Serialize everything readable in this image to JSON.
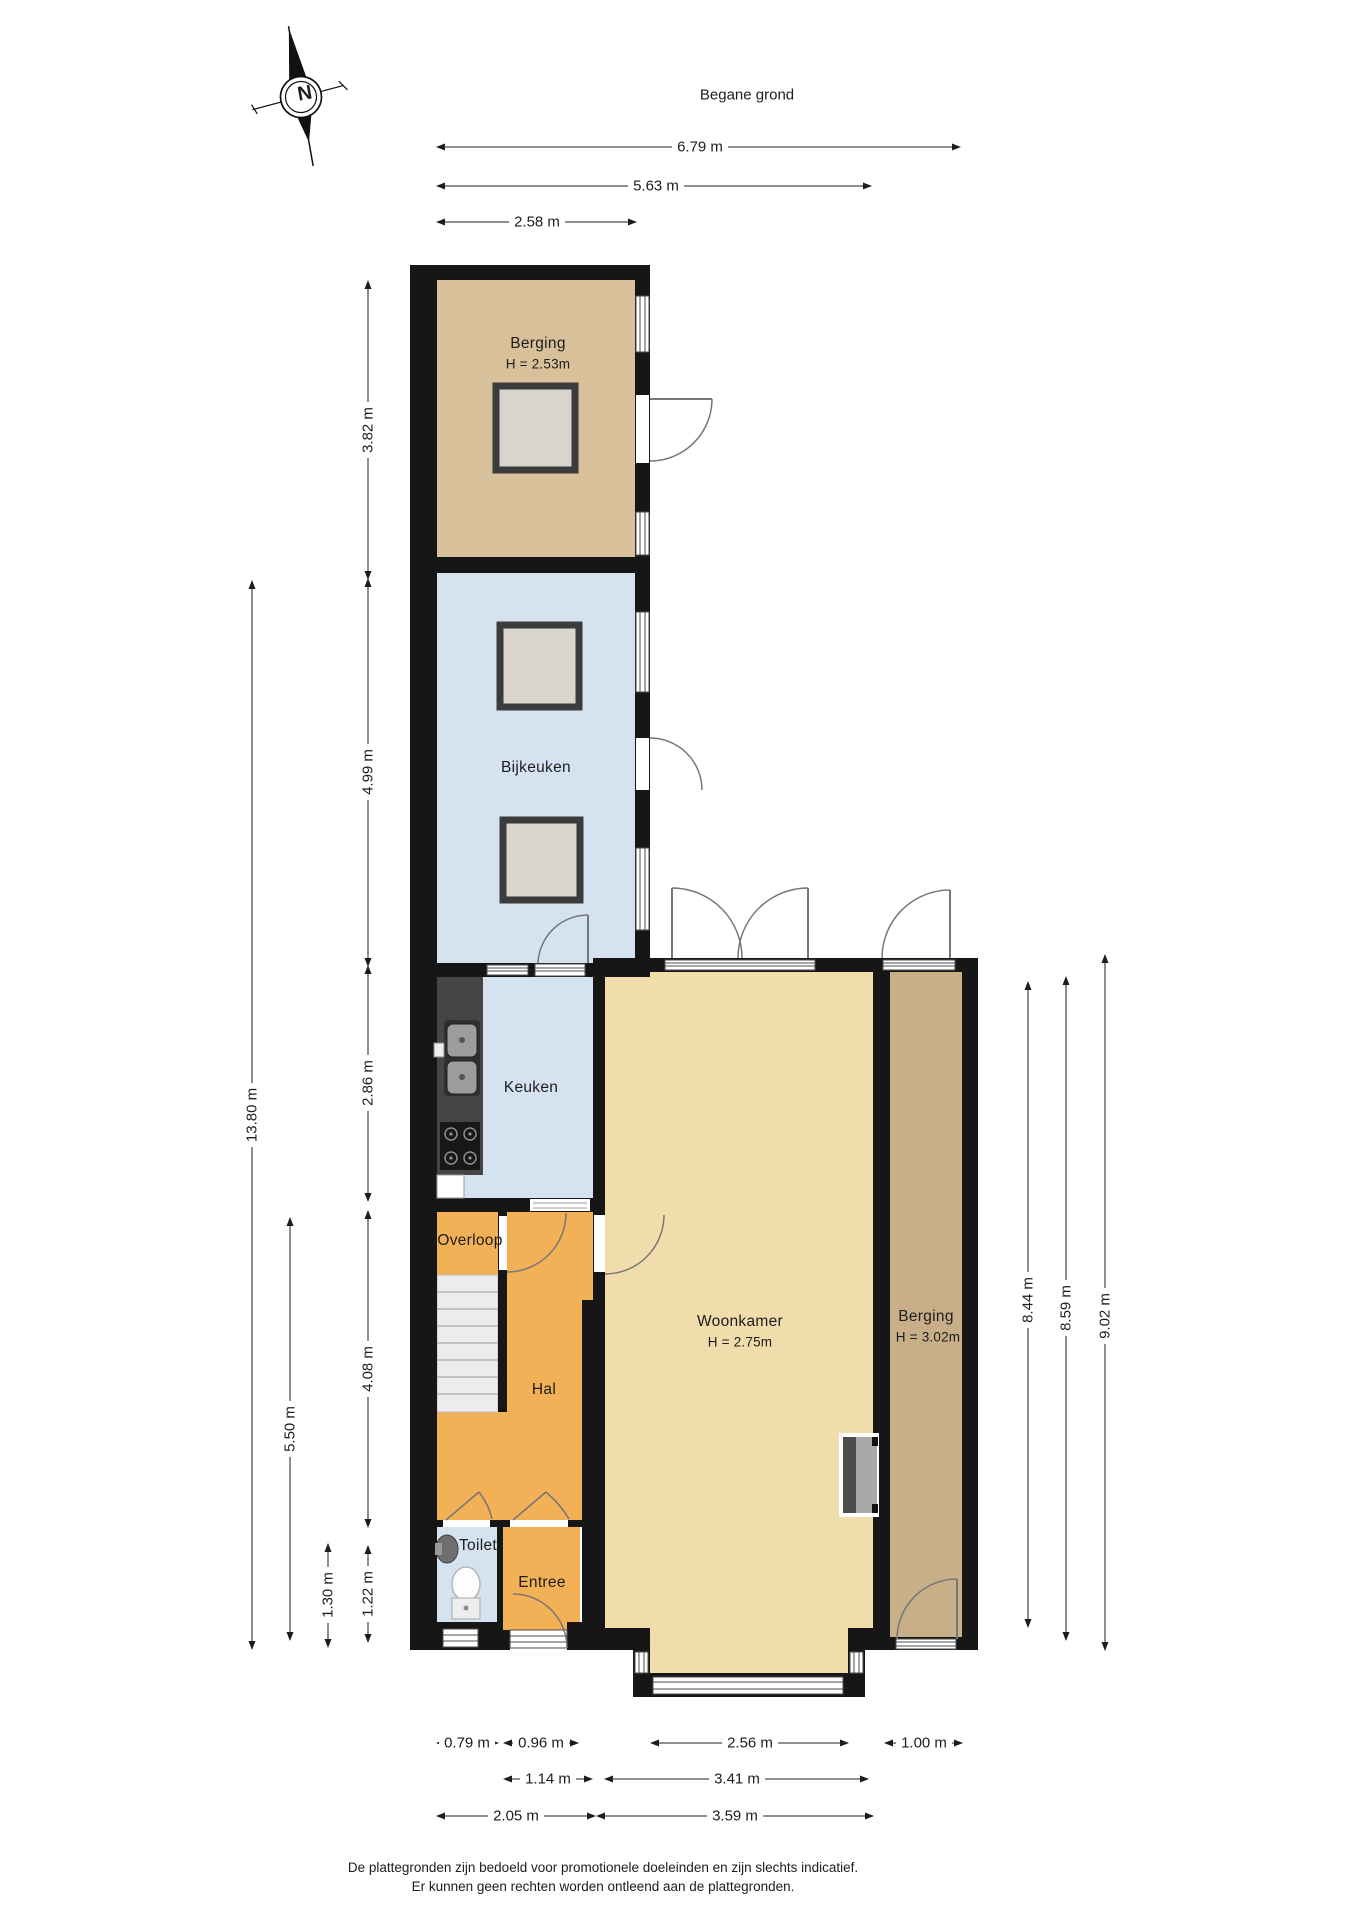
{
  "title": "Begane grond",
  "compass": {
    "letter": "N"
  },
  "rooms": {
    "berging_top": {
      "label": "Berging",
      "height": "H = 2.53m"
    },
    "bijkeuken": {
      "label": "Bijkeuken"
    },
    "keuken": {
      "label": "Keuken"
    },
    "overloop": {
      "label": "Overloop"
    },
    "hal": {
      "label": "Hal"
    },
    "toilet": {
      "label": "Toilet"
    },
    "entree": {
      "label": "Entree"
    },
    "woonkamer": {
      "label": "Woonkamer",
      "height": "H = 2.75m"
    },
    "berging_right": {
      "label": "Berging",
      "height": "H = 3.02m"
    }
  },
  "dimensions": {
    "top": [
      "6.79 m",
      "5.63 m",
      "2.58 m"
    ],
    "left": [
      "13.80 m",
      "5.50 m",
      "1.30 m",
      "3.82 m",
      "4.99 m",
      "2.86 m",
      "4.08 m",
      "1.22 m"
    ],
    "right": [
      "8.44 m",
      "8.59 m",
      "9.02 m"
    ],
    "bottom": [
      "0.79 m",
      "0.96 m",
      "2.56 m",
      "1.00 m",
      "1.14 m",
      "3.41 m",
      "2.05 m",
      "3.59 m"
    ]
  },
  "disclaimer": {
    "line1": "De plattegronden zijn bedoeld voor promotionele doeleinden en zijn slechts indicatief.",
    "line2": "Er kunnen geen rechten worden ontleend aan de plattegronden."
  },
  "colors": {
    "wall": "#161616",
    "berging_top_fill": "#d8c09b",
    "bijkeuken_fill": "#d5e3f0",
    "keuken_fill": "#d5e3f0",
    "toilet_fill": "#d5e3f0",
    "orange_fill": "#f2b057",
    "woonkamer_fill": "#f1dcab",
    "berging_right_fill": "#c8af87",
    "stairs_fill": "#ececec"
  }
}
